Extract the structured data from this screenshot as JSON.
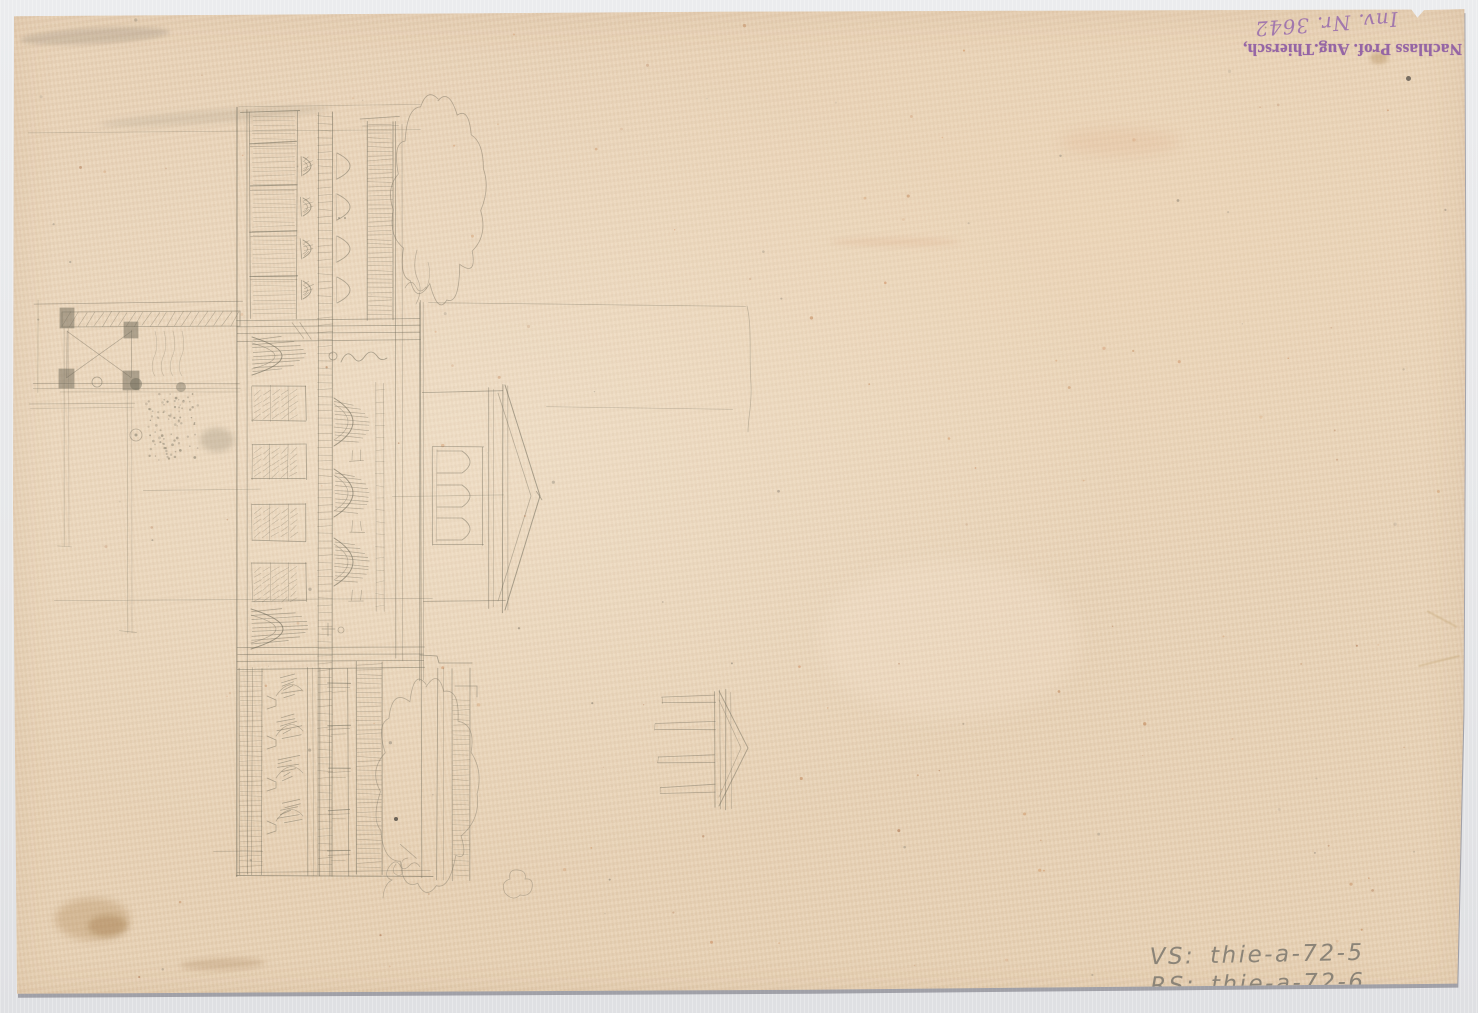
{
  "scan": {
    "paper_color": "#ecd7bc",
    "background_color": "#e8e9ea",
    "pencil_color": "#6e6959",
    "stamp": {
      "line1": "Nachlass Prof. Aug.Thiersch,",
      "line2": "Inv. Nr. 3642",
      "ink_color": "#8a57a3"
    },
    "inventory": {
      "line1": "VS: thie-a-72-5",
      "line2": "RS: thie-a-72-6",
      "pencil_color": "#8b8478"
    }
  }
}
